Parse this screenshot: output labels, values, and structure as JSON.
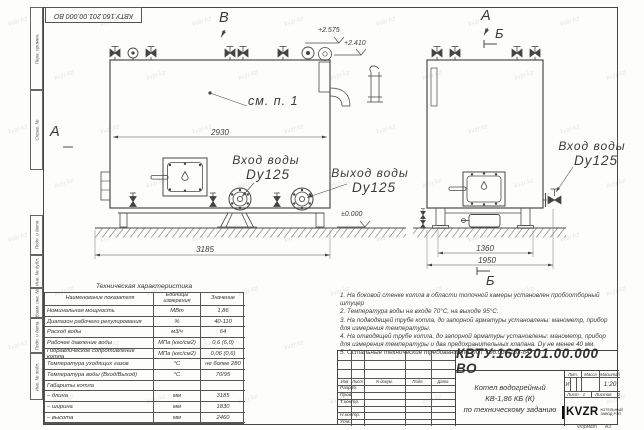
{
  "sheet": {
    "watermark": "kvzr.kz",
    "format_label": "Формат",
    "format_value": "А3"
  },
  "frame_stamps": {
    "top_designation": "КВТУ.160.201.00.000 ВО",
    "left_fields": [
      "Перв. примен.",
      "Справ. №",
      "Подп. и дата",
      "Инв. № дубл.",
      "Взам. инв. №",
      "Подп. и дата",
      "Инв. № подл."
    ]
  },
  "views": {
    "front": {
      "marker_a": "А",
      "marker_v": "В",
      "detail_ref": "см. п. 1",
      "dim_inner": "2930",
      "dim_overall": "3185",
      "elev_top": "+2.575",
      "elev_top2": "+2.410",
      "elev_ground": "±0.000",
      "inlet_label": "Вход воды",
      "inlet_size": "Dy125",
      "outlet_label": "Выход воды",
      "outlet_size": "Dy125"
    },
    "side": {
      "marker_a": "А",
      "marker_b": "Б",
      "marker_b_bottom": "Б",
      "dim_legs": "1360",
      "dim_depth": "1950",
      "inlet_label": "Вход воды",
      "inlet_size": "Dy125"
    }
  },
  "spec_table": {
    "title": "Техническая характеристика",
    "headers": [
      "Наименование показателя",
      "Единицы измерения",
      "Значение"
    ],
    "rows": [
      [
        "Номинальная мощность",
        "МВт",
        "1,86"
      ],
      [
        "Диапазон рабочего регулирования",
        "%",
        "40-110"
      ],
      [
        "Расход воды",
        "м3/ч",
        "64"
      ],
      [
        "Рабочее давление воды",
        "МПа (кгс/см2)",
        "0,6 (6,0)"
      ],
      [
        "Гидравлическое сопротивление котла",
        "МПа (кгс/см2)",
        "0,06 (0,6)"
      ],
      [
        "Температура уходящих газов",
        "°С",
        "не более 280"
      ],
      [
        "Температура воды (Вход/Выход)",
        "°С",
        "70/95"
      ],
      [
        "Габариты котла",
        "",
        ""
      ],
      [
        "– длина",
        "мм",
        "3185"
      ],
      [
        "– ширина",
        "мм",
        "1830"
      ],
      [
        "– высота",
        "мм",
        "2460"
      ]
    ]
  },
  "notes": {
    "lines": [
      "1. На боковой стенке котла в области топочной камеры установлен пробоотборный штуцер",
      "2. Температура воды на входе 70°С, на выходе 95°С.",
      "3. На подводящей трубе котла, до запорной арматуры установлены: манометр, прибор для измерения температуры.",
      "4. На отводящей трубе котла, до запорной арматуры установлены: манометр, прибор для измерения температуры и два предохранительных клапана. Dу не менее 40 мм.",
      "5. Остальные технические требования по ОСТ 108.030.133-84."
    ]
  },
  "title_block": {
    "designation": "КВТУ.160.201.00.000 ВО",
    "doc_name_line1": "Котел водогрейный",
    "doc_name_line2": "КВ-1,86 КБ (К)",
    "doc_name_line3": "по техническому заданию",
    "header_cols": [
      "Изм",
      "Лист",
      "N докум.",
      "Подп.",
      "Дата"
    ],
    "row_labels": [
      "Разраб.",
      "Пров.",
      "Т.контр.",
      "Н.контр.",
      "Утв."
    ],
    "lit_header": "Лит.",
    "mass_header": "Масса",
    "scale_header": "Масштаб",
    "lit_value": "И",
    "scale_value": "1:20",
    "sheet_label": "Лист",
    "sheet_value": "1",
    "sheets_label": "Листов",
    "sheets_value": "2",
    "company_logo": "KVZR",
    "company_name_line1": "КОТЕЛЬНЫЙ",
    "company_name_line2": "ЗАВОД РЭП"
  }
}
